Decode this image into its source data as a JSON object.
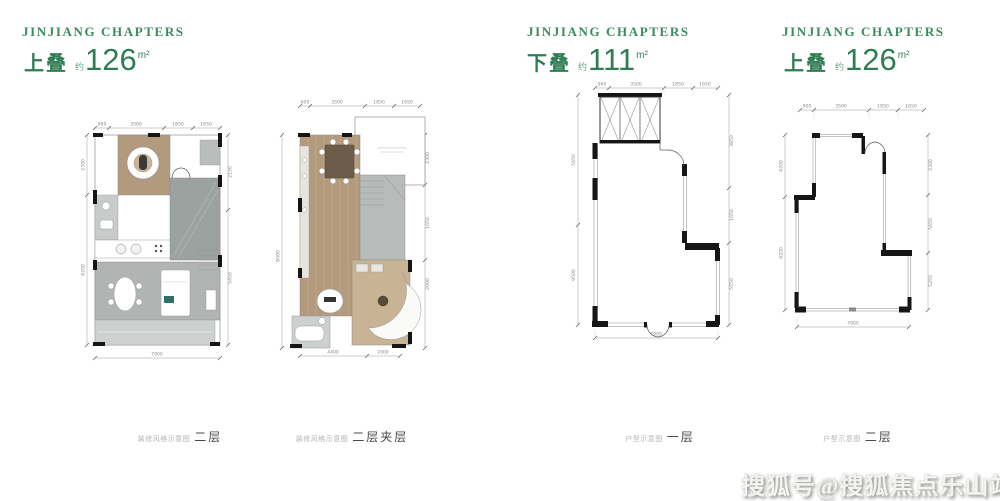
{
  "brand": "JINJIANG CHAPTERS",
  "watermark": "搜狐号@搜狐焦点乐山站",
  "colors": {
    "brand_green": "#3c8b60",
    "unit_green": "#2f7d53",
    "wall_black": "#161616",
    "wood_floor": "#b49a7c",
    "tile_gray": "#a9afad",
    "dim_gray": "#8a8a8a"
  },
  "panels": [
    {
      "type_label": "上叠",
      "approx_label": "约",
      "area_value": "126",
      "area_unit": "m²",
      "caption_prefix": "装修风格示意图",
      "caption_floor": "二层",
      "dims": {
        "top": [
          "900",
          "3500",
          "1850",
          "1650"
        ],
        "left": [
          "2300",
          "8200"
        ],
        "right": [
          "2150",
          "5450"
        ],
        "bottom": [
          "7900"
        ]
      }
    },
    {
      "caption_prefix": "装修风格示意图",
      "caption_floor": "二层夹层",
      "dims": {
        "top": [
          "600",
          "3500",
          "1850",
          "1650"
        ],
        "left": [
          "8000"
        ],
        "right": [
          "2300",
          "1650",
          "2000"
        ],
        "bottom": [
          "4400",
          "2000"
        ]
      }
    },
    {
      "type_label": "下叠",
      "approx_label": "约",
      "area_value": "111",
      "area_unit": "m²",
      "caption_prefix": "户型示意图",
      "caption_floor": "一层",
      "dims": {
        "top": [
          "900",
          "3500",
          "1850",
          "1650"
        ],
        "left": [
          "5650",
          "9500"
        ],
        "right": [
          "3850",
          "1650",
          "5550"
        ],
        "bottom": [
          "7900"
        ]
      }
    },
    {
      "type_label": "上叠",
      "approx_label": "约",
      "area_value": "126",
      "area_unit": "m²",
      "caption_prefix": "户型示意图",
      "caption_floor": "二层",
      "dims": {
        "top": [
          "900",
          "3500",
          "1850",
          "1650"
        ],
        "left": [
          "4200",
          "9200"
        ],
        "right": [
          "2300",
          "5650",
          "5250"
        ],
        "bottom": [
          "7900"
        ]
      }
    }
  ]
}
